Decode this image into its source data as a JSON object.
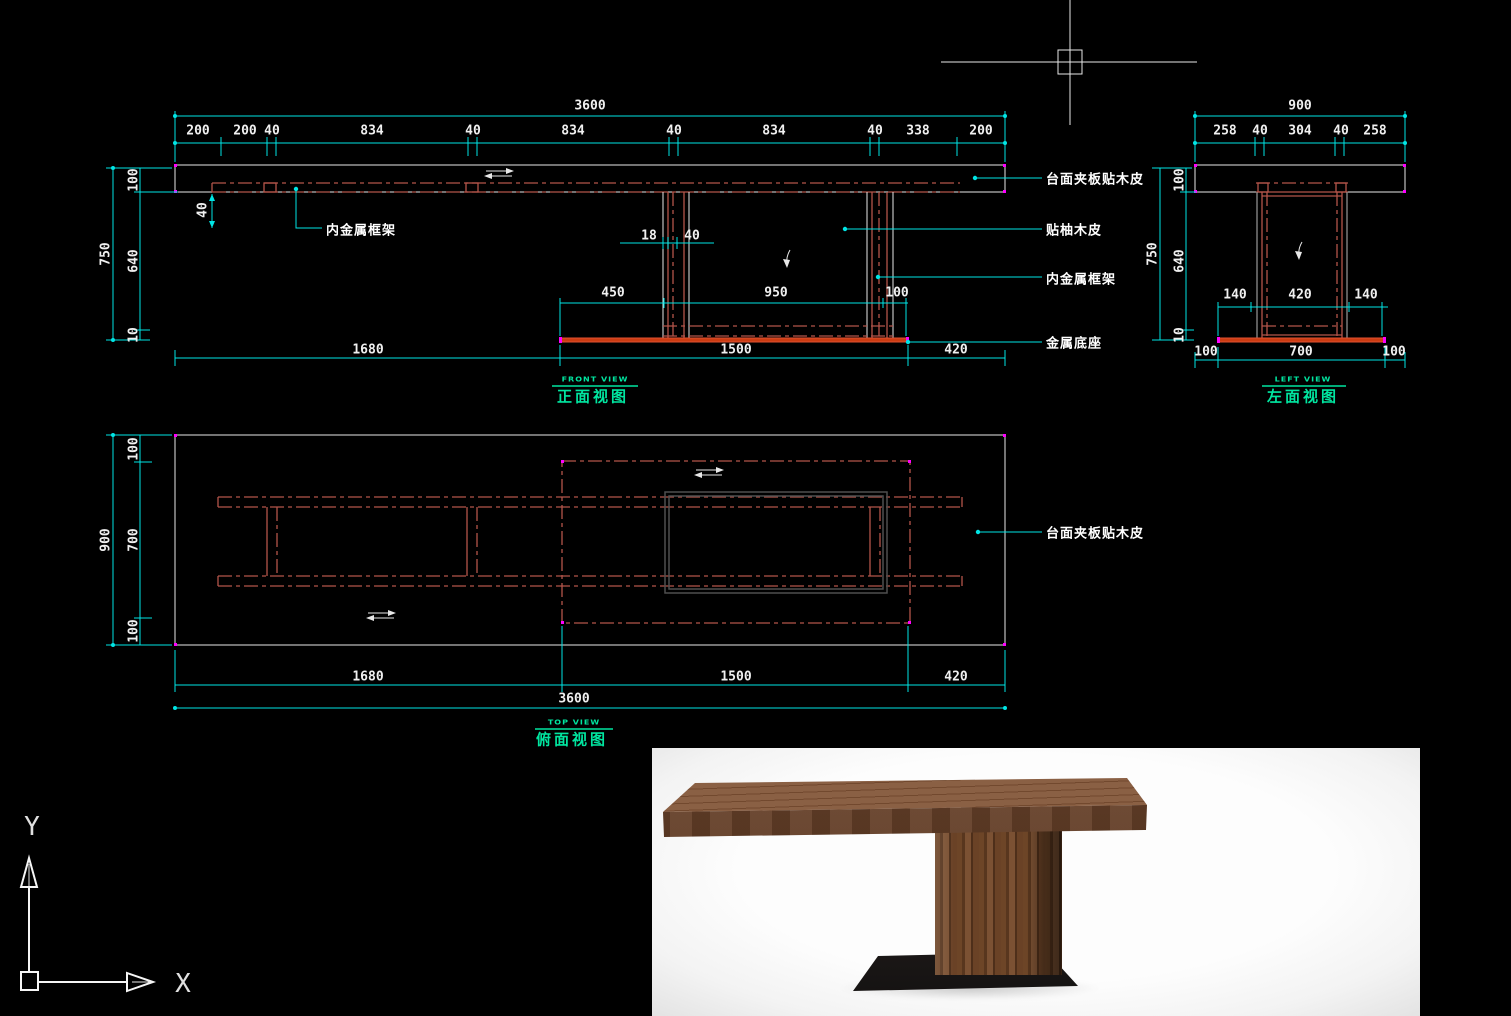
{
  "app": {
    "background": "#000000",
    "type": "cad-drawing-viewport"
  },
  "colors": {
    "dimension": "#00e5e5",
    "outline": "#e8e8e8",
    "frame_red": "#b4554a",
    "base_red": "#cc3c12",
    "view_title_green": "#00e6a0",
    "text_white": "#f0f0f0",
    "corner_marker_magenta": "#ff00ff"
  },
  "cursor": {
    "type": "crosshair-with-pickbox",
    "x": 1070,
    "y": 62
  },
  "ucs_icon": {
    "x_label": "X",
    "y_label": "Y"
  },
  "views": {
    "front": {
      "title": "正面视图",
      "subtitle": "FRONT VIEW"
    },
    "left": {
      "title": "左面视图",
      "subtitle": "LEFT VIEW"
    },
    "top": {
      "title": "俯面视图",
      "subtitle": "TOP VIEW"
    }
  },
  "texts": [
    {
      "name": "dim-front-total",
      "t": "3600",
      "x": 590,
      "y": 106
    },
    {
      "name": "dim-front-seg",
      "t": "200",
      "x": 198,
      "y": 131
    },
    {
      "name": "dim-front-seg",
      "t": "200",
      "x": 245,
      "y": 131
    },
    {
      "name": "dim-front-seg",
      "t": "40",
      "x": 272,
      "y": 131
    },
    {
      "name": "dim-front-seg",
      "t": "834",
      "x": 372,
      "y": 131
    },
    {
      "name": "dim-front-seg",
      "t": "40",
      "x": 473,
      "y": 131
    },
    {
      "name": "dim-front-seg",
      "t": "834",
      "x": 573,
      "y": 131
    },
    {
      "name": "dim-front-seg",
      "t": "40",
      "x": 674,
      "y": 131
    },
    {
      "name": "dim-front-seg",
      "t": "834",
      "x": 774,
      "y": 131
    },
    {
      "name": "dim-front-seg",
      "t": "40",
      "x": 875,
      "y": 131
    },
    {
      "name": "dim-front-seg",
      "t": "338",
      "x": 918,
      "y": 131
    },
    {
      "name": "dim-front-seg",
      "t": "200",
      "x": 981,
      "y": 131
    },
    {
      "name": "dim-front-height",
      "t": "750",
      "x": 106,
      "y": 254,
      "cls": "dimr"
    },
    {
      "name": "dim-front-seg",
      "t": "100",
      "x": 134,
      "y": 180,
      "cls": "dimr"
    },
    {
      "name": "dim-front-seg",
      "t": "640",
      "x": 134,
      "y": 261,
      "cls": "dimr"
    },
    {
      "name": "dim-front-seg",
      "t": "10",
      "x": 134,
      "y": 335,
      "cls": "dimr"
    },
    {
      "name": "dim-front-seg",
      "t": "40",
      "x": 203,
      "y": 210,
      "cls": "dimr"
    },
    {
      "name": "dim-front-seg",
      "t": "18",
      "x": 649,
      "y": 236
    },
    {
      "name": "dim-front-seg",
      "t": "40",
      "x": 692,
      "y": 236
    },
    {
      "name": "dim-front-seg",
      "t": "450",
      "x": 613,
      "y": 293
    },
    {
      "name": "dim-front-seg",
      "t": "950",
      "x": 776,
      "y": 293
    },
    {
      "name": "dim-front-seg",
      "t": "100",
      "x": 897,
      "y": 293
    },
    {
      "name": "dim-front-seg",
      "t": "1680",
      "x": 368,
      "y": 350
    },
    {
      "name": "dim-front-seg",
      "t": "1500",
      "x": 736,
      "y": 350
    },
    {
      "name": "dim-front-seg",
      "t": "420",
      "x": 956,
      "y": 350
    },
    {
      "name": "front-view-subtitle",
      "t": "FRONT VIEW",
      "x": 595,
      "y": 379,
      "cls": "gsub"
    },
    {
      "name": "front-view-title",
      "t": "正面视图",
      "x": 593,
      "y": 396,
      "cls": "gtitle"
    },
    {
      "name": "annotation-tabletop",
      "t": "台面夹板贴木皮",
      "x": 1046,
      "y": 178,
      "cls": "ann"
    },
    {
      "name": "annotation-veneer",
      "t": "贴柚木皮",
      "x": 1046,
      "y": 229,
      "cls": "ann"
    },
    {
      "name": "annotation-inner-frame",
      "t": "内金属框架",
      "x": 1046,
      "y": 278,
      "cls": "ann"
    },
    {
      "name": "annotation-metal-base",
      "t": "金属底座",
      "x": 1046,
      "y": 342,
      "cls": "ann"
    },
    {
      "name": "annotation-inner-frame-left",
      "t": "内金属框架",
      "x": 326,
      "y": 229,
      "cls": "ann"
    },
    {
      "name": "dim-left-total",
      "t": "900",
      "x": 1300,
      "y": 106
    },
    {
      "name": "dim-left-seg",
      "t": "258",
      "x": 1225,
      "y": 131
    },
    {
      "name": "dim-left-seg",
      "t": "40",
      "x": 1260,
      "y": 131
    },
    {
      "name": "dim-left-seg",
      "t": "304",
      "x": 1300,
      "y": 131
    },
    {
      "name": "dim-left-seg",
      "t": "40",
      "x": 1341,
      "y": 131
    },
    {
      "name": "dim-left-seg",
      "t": "258",
      "x": 1375,
      "y": 131
    },
    {
      "name": "dim-left-height",
      "t": "750",
      "x": 1153,
      "y": 254,
      "cls": "dimr"
    },
    {
      "name": "dim-left-seg",
      "t": "100",
      "x": 1180,
      "y": 180,
      "cls": "dimr"
    },
    {
      "name": "dim-left-seg",
      "t": "640",
      "x": 1180,
      "y": 261,
      "cls": "dimr"
    },
    {
      "name": "dim-left-seg",
      "t": "10",
      "x": 1180,
      "y": 335,
      "cls": "dimr"
    },
    {
      "name": "dim-left-seg",
      "t": "140",
      "x": 1235,
      "y": 295
    },
    {
      "name": "dim-left-seg",
      "t": "420",
      "x": 1300,
      "y": 295
    },
    {
      "name": "dim-left-seg",
      "t": "140",
      "x": 1366,
      "y": 295
    },
    {
      "name": "dim-left-seg",
      "t": "100",
      "x": 1206,
      "y": 352
    },
    {
      "name": "dim-left-seg",
      "t": "700",
      "x": 1301,
      "y": 352
    },
    {
      "name": "dim-left-seg",
      "t": "100",
      "x": 1394,
      "y": 352
    },
    {
      "name": "left-view-subtitle",
      "t": "LEFT VIEW",
      "x": 1303,
      "y": 379,
      "cls": "gsub"
    },
    {
      "name": "left-view-title",
      "t": "左面视图",
      "x": 1303,
      "y": 396,
      "cls": "gtitle"
    },
    {
      "name": "dim-top-depth",
      "t": "900",
      "x": 106,
      "y": 540,
      "cls": "dimr"
    },
    {
      "name": "dim-top-seg",
      "t": "100",
      "x": 134,
      "y": 449,
      "cls": "dimr"
    },
    {
      "name": "dim-top-seg",
      "t": "700",
      "x": 134,
      "y": 540,
      "cls": "dimr"
    },
    {
      "name": "dim-top-seg",
      "t": "100",
      "x": 134,
      "y": 631,
      "cls": "dimr"
    },
    {
      "name": "dim-top-seg",
      "t": "1680",
      "x": 368,
      "y": 677
    },
    {
      "name": "dim-top-seg",
      "t": "1500",
      "x": 736,
      "y": 677
    },
    {
      "name": "dim-top-seg",
      "t": "420",
      "x": 956,
      "y": 677
    },
    {
      "name": "dim-top-total",
      "t": "3600",
      "x": 574,
      "y": 699
    },
    {
      "name": "top-view-subtitle",
      "t": "TOP VIEW",
      "x": 574,
      "y": 722,
      "cls": "gsub"
    },
    {
      "name": "top-view-title",
      "t": "俯面视图",
      "x": 572,
      "y": 739,
      "cls": "gtitle"
    },
    {
      "name": "annotation-tabletop-top",
      "t": "台面夹板贴木皮",
      "x": 1046,
      "y": 532,
      "cls": "ann"
    },
    {
      "name": "ucs-y-label",
      "t": "Y",
      "x": 32,
      "y": 827,
      "cls": "axis"
    },
    {
      "name": "ucs-x-label",
      "t": "X",
      "x": 183,
      "y": 984,
      "cls": "axis"
    }
  ]
}
